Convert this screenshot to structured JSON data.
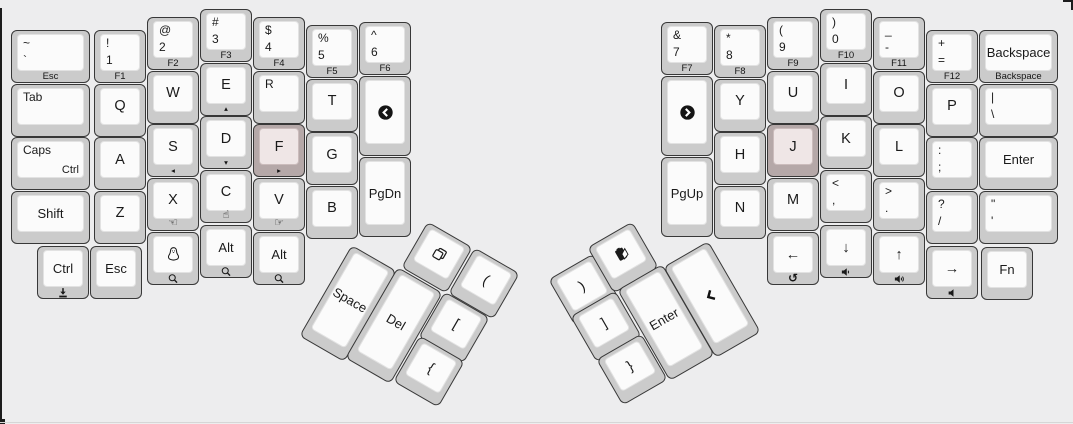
{
  "canvas": {
    "width": 1073,
    "height": 424,
    "background": "#ededee"
  },
  "colors": {
    "key_border": "#383838",
    "key_outer": "#cbcbcb",
    "key_inner": "#fbfbfb",
    "key_inner_border": "#e2e2e2",
    "home_key_outer": "#b5a8a8",
    "home_key_inner": "#efe6e6",
    "home_key_inner_border": "#cbbcbc",
    "legend_color": "#1a1a1a"
  },
  "keys": [
    {
      "n": "grave-esc",
      "x": 11,
      "y": 30,
      "w": 79,
      "tl": [
        "~",
        "`"
      ],
      "front": "Esc"
    },
    {
      "n": "tab",
      "x": 11,
      "y": 83.5,
      "w": 79,
      "tl": [
        "Tab"
      ]
    },
    {
      "n": "caps-ctrl",
      "x": 11,
      "y": 137,
      "w": 79,
      "tl": [
        "Caps"
      ],
      "br": "Ctrl"
    },
    {
      "n": "shift-left",
      "x": 11,
      "y": 190.5,
      "w": 79,
      "c": "Shift"
    },
    {
      "n": "ctrl-left",
      "x": 37,
      "y": 246,
      "c": "Ctrl",
      "fi": "download-icon"
    },
    {
      "n": "esc-bottom",
      "x": 90,
      "y": 246,
      "c": "Esc"
    },
    {
      "n": "f1",
      "x": 94,
      "y": 30,
      "tl": [
        "!",
        "1"
      ],
      "front": "F1"
    },
    {
      "n": "q",
      "x": 94,
      "y": 83.5,
      "c": "Q"
    },
    {
      "n": "a",
      "x": 94,
      "y": 137,
      "c": "A"
    },
    {
      "n": "z",
      "x": 94,
      "y": 190.5,
      "c": "Z"
    },
    {
      "n": "f2",
      "x": 147,
      "y": 17,
      "tl": [
        "@",
        "2"
      ],
      "front": "F2"
    },
    {
      "n": "w",
      "x": 147,
      "y": 70.5,
      "c": "W"
    },
    {
      "n": "s",
      "x": 147,
      "y": 124,
      "c": "S",
      "front": "◂"
    },
    {
      "n": "x",
      "x": 147,
      "y": 177.5,
      "c": "X",
      "front": "☜"
    },
    {
      "n": "tux",
      "x": 147,
      "y": 232,
      "ci": "tux-icon",
      "fi": "magnifier-icon"
    },
    {
      "n": "f3",
      "x": 200,
      "y": 9,
      "tl": [
        "#",
        "3"
      ],
      "front": "F3"
    },
    {
      "n": "e",
      "x": 200,
      "y": 62.5,
      "c": "E",
      "front": "▴"
    },
    {
      "n": "d",
      "x": 200,
      "y": 116,
      "c": "D",
      "front": "▾"
    },
    {
      "n": "c",
      "x": 200,
      "y": 169.5,
      "c": "C",
      "front": "☝"
    },
    {
      "n": "alt-left",
      "x": 200,
      "y": 225,
      "c": "Alt",
      "fi": "magnifier-icon"
    },
    {
      "n": "f4",
      "x": 253,
      "y": 17,
      "tl": [
        "$",
        "4"
      ],
      "front": "F4"
    },
    {
      "n": "r",
      "x": 253,
      "y": 70.5,
      "tl": [
        "R"
      ]
    },
    {
      "n": "f",
      "x": 253,
      "y": 124,
      "c": "F",
      "front": "▸",
      "home": true
    },
    {
      "n": "v",
      "x": 253,
      "y": 177.5,
      "c": "V",
      "front": "☞"
    },
    {
      "n": "alt-left-2",
      "x": 253,
      "y": 232,
      "c": "Alt",
      "fi": "magnifier-icon"
    },
    {
      "n": "f5",
      "x": 306,
      "y": 25,
      "tl": [
        "%",
        "5"
      ],
      "front": "F5"
    },
    {
      "n": "t",
      "x": 306,
      "y": 78.5,
      "c": "T"
    },
    {
      "n": "g",
      "x": 306,
      "y": 132,
      "c": "G"
    },
    {
      "n": "b",
      "x": 306,
      "y": 185.5,
      "c": "B"
    },
    {
      "n": "f6",
      "x": 359,
      "y": 22,
      "tl": [
        "^",
        "6"
      ],
      "front": "F6"
    },
    {
      "n": "nav-back",
      "x": 359,
      "y": 76,
      "h": 80,
      "ci": "circle-chevron-left-icon"
    },
    {
      "n": "pgdn",
      "x": 359,
      "y": 157,
      "h": 80,
      "c": "PgDn"
    },
    {
      "n": "space",
      "cx": 348,
      "cy": 303,
      "h": 105,
      "rot": 30,
      "c": "Space"
    },
    {
      "n": "del",
      "cx": 394,
      "cy": 325,
      "h": 105,
      "rot": 30,
      "c": "Del"
    },
    {
      "n": "copy",
      "cx": 437,
      "cy": 257,
      "rot": 30,
      "ci": "copy-icon"
    },
    {
      "n": "paren-left",
      "cx": 484,
      "cy": 283,
      "rot": 30,
      "c": "("
    },
    {
      "n": "bracket-left",
      "cx": 454,
      "cy": 327,
      "rot": 30,
      "c": "["
    },
    {
      "n": "brace-left",
      "cx": 429,
      "cy": 371,
      "rot": 30,
      "c": "{"
    },
    {
      "n": "paren-right",
      "cx": 584,
      "cy": 289,
      "rot": -30,
      "c": ")"
    },
    {
      "n": "paste",
      "cx": 623,
      "cy": 257,
      "rot": -30,
      "ci": "paste-icon"
    },
    {
      "n": "bracket-right",
      "cx": 606,
      "cy": 326,
      "rot": -30,
      "c": "]"
    },
    {
      "n": "brace-right",
      "cx": 632,
      "cy": 369,
      "rot": -30,
      "c": "}"
    },
    {
      "n": "enter-thumb",
      "cx": 666,
      "cy": 322,
      "h": 105,
      "rot": -30,
      "c": "Enter"
    },
    {
      "n": "nav-chevron",
      "cx": 712,
      "cy": 299,
      "h": 105,
      "rot": -30,
      "ci": "chevron-left-bold-icon"
    },
    {
      "n": "f7",
      "x": 661,
      "y": 22,
      "tl": [
        "&",
        "7"
      ],
      "front": "F7"
    },
    {
      "n": "nav-forward",
      "x": 661,
      "y": 76,
      "h": 80,
      "ci": "circle-chevron-right-icon"
    },
    {
      "n": "pgup",
      "x": 661,
      "y": 157,
      "h": 80,
      "c": "PgUp"
    },
    {
      "n": "f8",
      "x": 714,
      "y": 25,
      "tl": [
        "*",
        "8"
      ],
      "front": "F8"
    },
    {
      "n": "y",
      "x": 714,
      "y": 78.5,
      "c": "Y"
    },
    {
      "n": "h",
      "x": 714,
      "y": 132,
      "c": "H"
    },
    {
      "n": "n",
      "x": 714,
      "y": 185.5,
      "c": "N"
    },
    {
      "n": "f9",
      "x": 767,
      "y": 17,
      "tl": [
        "(",
        "9"
      ],
      "front": "F9"
    },
    {
      "n": "u",
      "x": 767,
      "y": 70.5,
      "c": "U"
    },
    {
      "n": "j",
      "x": 767,
      "y": 124,
      "c": "J",
      "home": true
    },
    {
      "n": "m",
      "x": 767,
      "y": 177.5,
      "c": "M"
    },
    {
      "n": "arrow-left",
      "x": 767,
      "y": 232,
      "c": "←",
      "front": "↺"
    },
    {
      "n": "f10",
      "x": 820,
      "y": 9,
      "tl": [
        ")",
        "0"
      ],
      "front": "F10"
    },
    {
      "n": "i",
      "x": 820,
      "y": 62.5,
      "c": "I"
    },
    {
      "n": "k",
      "x": 820,
      "y": 116,
      "c": "K"
    },
    {
      "n": "comma",
      "x": 820,
      "y": 169.5,
      "tl": [
        "<",
        ","
      ]
    },
    {
      "n": "arrow-down",
      "x": 820,
      "y": 225,
      "c": "↓",
      "fi": "volume-down-icon"
    },
    {
      "n": "f11",
      "x": 873,
      "y": 17,
      "tl": [
        "_",
        "-"
      ],
      "front": "F11"
    },
    {
      "n": "o",
      "x": 873,
      "y": 70.5,
      "c": "O"
    },
    {
      "n": "l",
      "x": 873,
      "y": 124,
      "c": "L"
    },
    {
      "n": "period",
      "x": 873,
      "y": 177.5,
      "tl": [
        ">",
        "."
      ]
    },
    {
      "n": "arrow-up",
      "x": 873,
      "y": 232,
      "c": "↑",
      "fi": "volume-up-icon"
    },
    {
      "n": "f12",
      "x": 926,
      "y": 30,
      "tl": [
        "+",
        "="
      ],
      "front": "F12"
    },
    {
      "n": "p",
      "x": 926,
      "y": 83.5,
      "c": "P"
    },
    {
      "n": "semicolon",
      "x": 926,
      "y": 137,
      "tl": [
        ":",
        ";"
      ]
    },
    {
      "n": "slash",
      "x": 926,
      "y": 190.5,
      "tl": [
        "?",
        "/"
      ]
    },
    {
      "n": "arrow-right",
      "x": 926,
      "y": 246,
      "c": "→",
      "fi": "volume-mute-icon"
    },
    {
      "n": "backspace",
      "x": 979,
      "y": 30,
      "w": 79,
      "c": "Backspace",
      "front": "Backspace"
    },
    {
      "n": "pipe",
      "x": 979,
      "y": 83.5,
      "w": 79,
      "tl": [
        "|",
        "\\"
      ]
    },
    {
      "n": "enter-right",
      "x": 979,
      "y": 137,
      "w": 79,
      "c": "Enter"
    },
    {
      "n": "quote",
      "x": 979,
      "y": 190.5,
      "w": 79,
      "tl": [
        "\"",
        "'"
      ]
    },
    {
      "n": "fn",
      "x": 981,
      "y": 247,
      "c": "Fn"
    }
  ]
}
